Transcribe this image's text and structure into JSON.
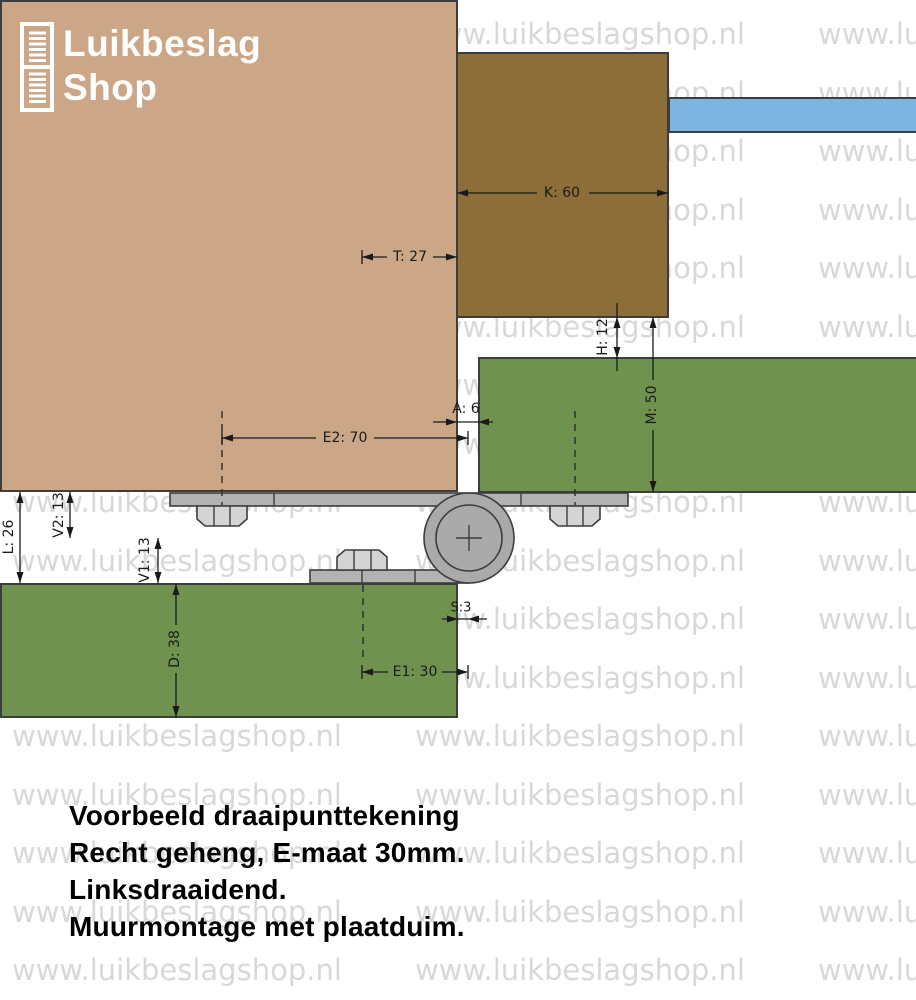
{
  "header": {
    "logo": {
      "line1": "Luikbeslag",
      "line2": "Shop"
    }
  },
  "watermark": {
    "text": "www.luikbeslagshop.nl",
    "color": "#d8d8d8"
  },
  "drawing": {
    "colors": {
      "wall": "#cba687",
      "frame": "#8c6e38",
      "glass": "#7db4e2",
      "shutter": "#6f934f",
      "plate": "#b2b2b2",
      "bolt": "#d4d4d4",
      "pivot": "#aaaaaa",
      "outline": "#3d3d3d"
    },
    "dimensions": {
      "t": "T: 27",
      "k": "K: 60",
      "h": "H: 12",
      "m": "M: 50",
      "a": "A: 6",
      "e2": "E2: 70",
      "v2": "V2: 13",
      "l": "L: 26",
      "v1": "V1: 13",
      "d": "D: 38",
      "s": "S:3",
      "e1": "E1: 30"
    }
  },
  "caption": {
    "line1": "Voorbeeld draaipunttekening",
    "line2": "Recht geheng, E-maat 30mm.",
    "line3": "Linksdraaidend.",
    "line4": "Muurmontage met plaatduim."
  }
}
